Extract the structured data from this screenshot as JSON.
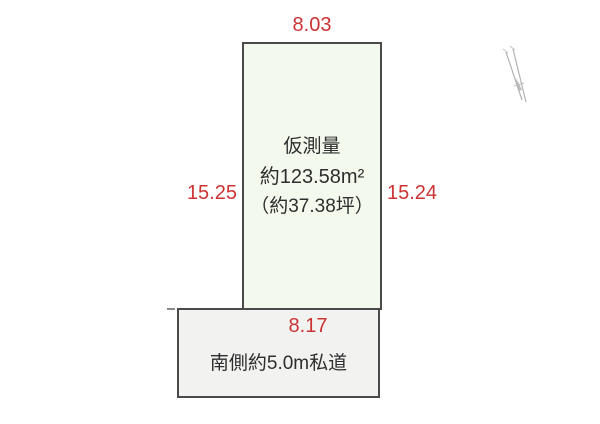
{
  "diagram": {
    "dimensions": {
      "top": "8.03",
      "left": "15.25",
      "right": "15.24",
      "south": "8.17"
    },
    "plot": {
      "survey_label": "仮測量",
      "area_m2": "約123.58m²",
      "area_tsubo": "（約37.38坪）"
    },
    "road": {
      "label": "南側約5.0m私道"
    },
    "colors": {
      "plot_fill": "#f3f9ec",
      "road_fill": "#f2f2f1",
      "outline": "#4a4a4a",
      "dimension_text": "#cc3333",
      "label_text": "#2e2e2e"
    },
    "icons": {
      "north_arrow": "north-arrow-icon"
    }
  }
}
